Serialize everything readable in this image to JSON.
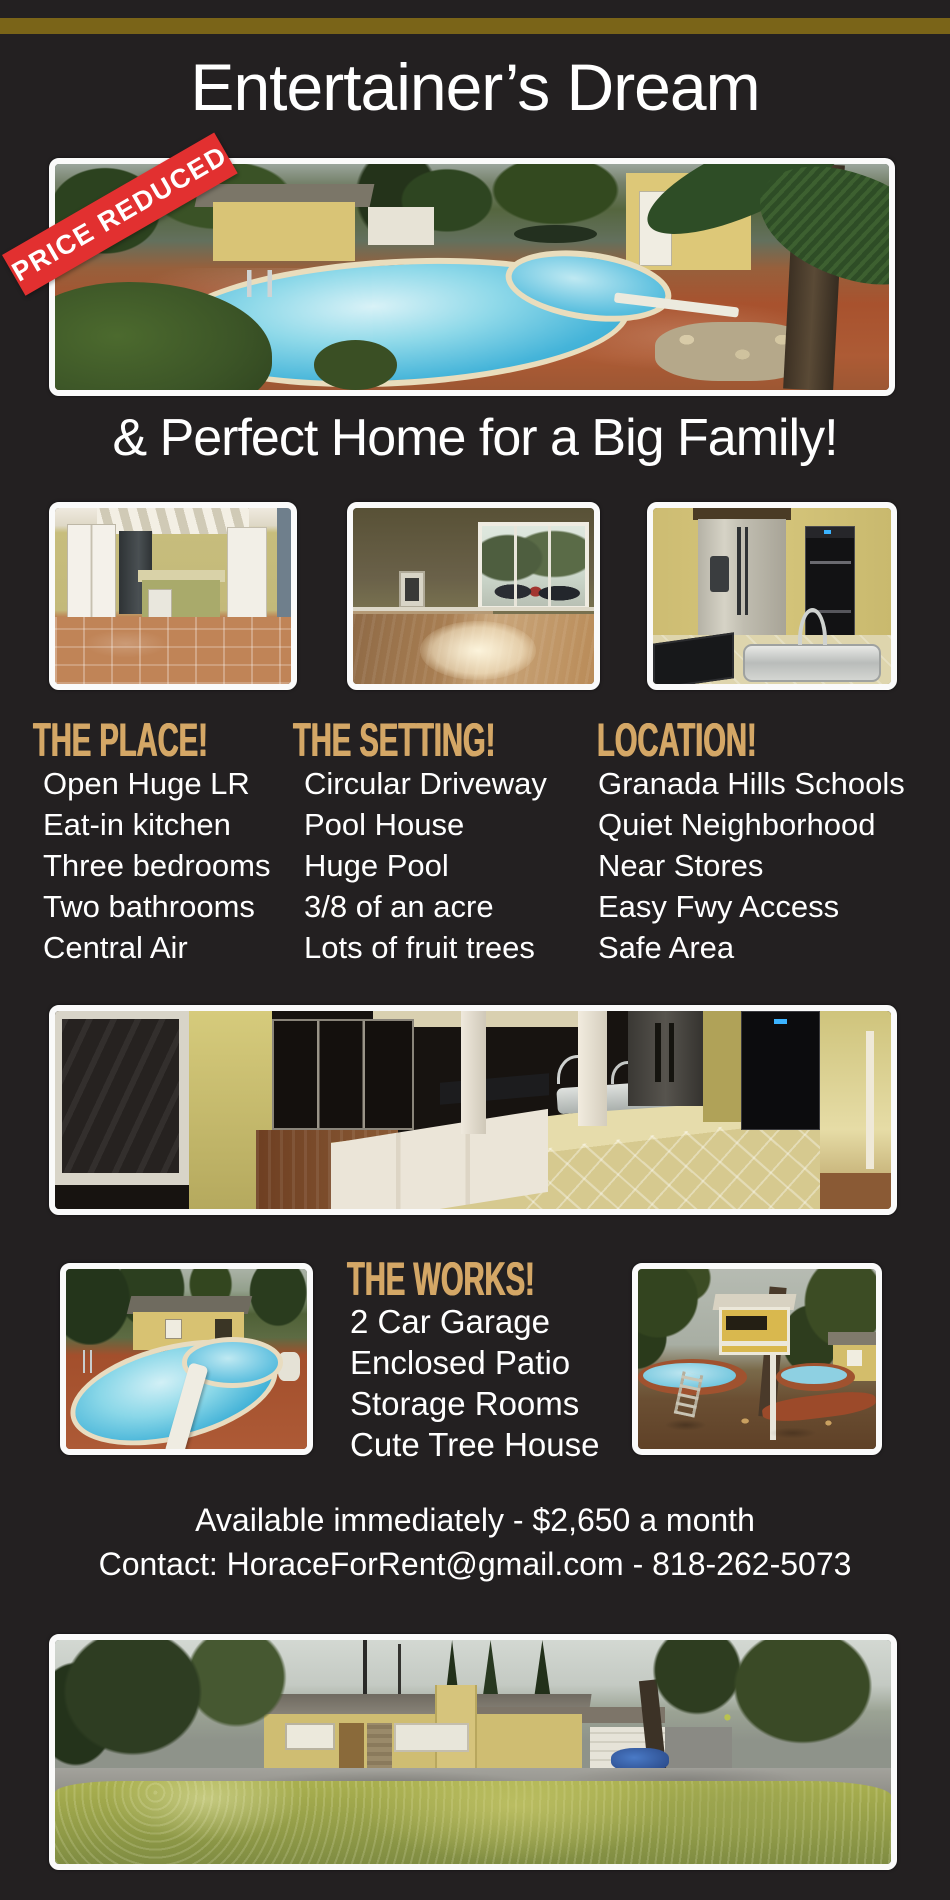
{
  "colors": {
    "background": "#232021",
    "gold_bar": "#7a6418",
    "heading": "#d4a766",
    "banner": "#e23030",
    "text": "#ffffff",
    "photo_border": "#fafafa"
  },
  "header": {
    "title": "Entertainer’s Dream",
    "price_banner": "PRICE REDUCED",
    "subtitle": "& Perfect Home for a Big Family!"
  },
  "sections": {
    "place": {
      "heading": "THE PLACE!",
      "items": [
        "Open Huge LR",
        "Eat-in kitchen",
        "Three bedrooms",
        "Two bathrooms",
        "Central Air"
      ]
    },
    "setting": {
      "heading": "THE SETTING!",
      "items": [
        "Circular Driveway",
        "Pool House",
        "Huge Pool",
        "3/8 of an acre",
        "Lots of fruit trees"
      ]
    },
    "location": {
      "heading": "LOCATION!",
      "items": [
        "Granada Hills Schools",
        "Quiet Neighborhood",
        "Near Stores",
        "Easy Fwy Access",
        "Safe Area"
      ]
    },
    "works": {
      "heading": "THE WORKS!",
      "items": [
        "2 Car Garage",
        "Enclosed Patio",
        "Storage Rooms",
        "Cute Tree House"
      ]
    }
  },
  "footer": {
    "availability": "Available immediately - $2,650 a month",
    "contact": "Contact: HoraceForRent@gmail.com - 818-262-5073"
  }
}
